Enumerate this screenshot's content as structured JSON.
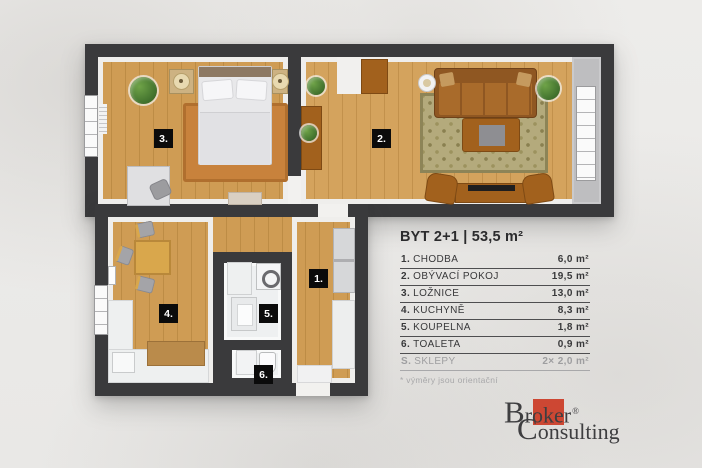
{
  "plan": {
    "type": "apartment-floorplan-3d-top-view",
    "badges": {
      "chodba": "1.",
      "obyvaci_pokoj": "2.",
      "loznice": "3.",
      "kuchyne": "4.",
      "koupelna": "5.",
      "toaleta": "6."
    }
  },
  "legend": {
    "title": "BYT 2+1 | 53,5 m²",
    "rows": [
      {
        "num": "1.",
        "label": "CHODBA",
        "area": "6,0 m²"
      },
      {
        "num": "2.",
        "label": "OBÝVACÍ POKOJ",
        "area": "19,5 m²"
      },
      {
        "num": "3.",
        "label": "LOŽNICE",
        "area": "13,0 m²"
      },
      {
        "num": "4.",
        "label": "KUCHYNĚ",
        "area": "8,3 m²"
      },
      {
        "num": "5.",
        "label": "KOUPELNA",
        "area": "1,8 m²"
      },
      {
        "num": "6.",
        "label": "TOALETA",
        "area": "0,9 m²"
      },
      {
        "num": "S.",
        "label": "SKLEPY",
        "area": "2× 2,0 m²"
      }
    ],
    "footnote": "* výměry jsou orientační"
  },
  "logo": {
    "word1_initial": "B",
    "word1_rest": "roker",
    "registered": "®",
    "word2_initial": "C",
    "word2_rest": "onsulting",
    "accent_color": "#cd4733"
  },
  "colors": {
    "wall": "#3a3a3c",
    "wood_floor": "#cf9c54",
    "background": "#ebeae8",
    "badge_bg": "#0b0b0b",
    "legend_text": "#38383a",
    "muted_text": "#9e9ea0"
  }
}
